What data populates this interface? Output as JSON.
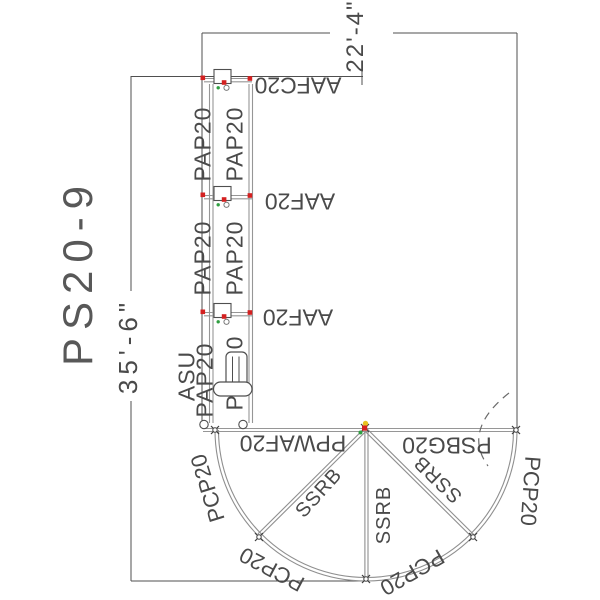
{
  "drawing": {
    "title": "PS20-9",
    "dim_width": "22'-4\"",
    "dim_height": "35'-6\"",
    "tower": {
      "frames": [
        "AAFC20",
        "AAF20",
        "AAF20"
      ],
      "bays": [
        {
          "left": "PAP20",
          "right": "PAP20"
        },
        {
          "left": "PAP20",
          "right": "PAP20"
        },
        {
          "left": "PAP20",
          "right": "PAP20"
        }
      ],
      "stair_unit": "ASU"
    },
    "ring": {
      "top_left": "PPWAF20",
      "top_right": "PSBG20",
      "spokes": [
        "SSRB",
        "SSRB",
        "SSRB"
      ],
      "arc_panels": [
        "PCP20",
        "PCP20",
        "PCP20",
        "PCP20"
      ]
    },
    "colors": {
      "line_dark": "#4f4f4f",
      "line_gray": "#969696",
      "marker_red": "#d42020",
      "marker_green": "#2f9e40",
      "marker_yellow": "#e7c21f"
    }
  }
}
